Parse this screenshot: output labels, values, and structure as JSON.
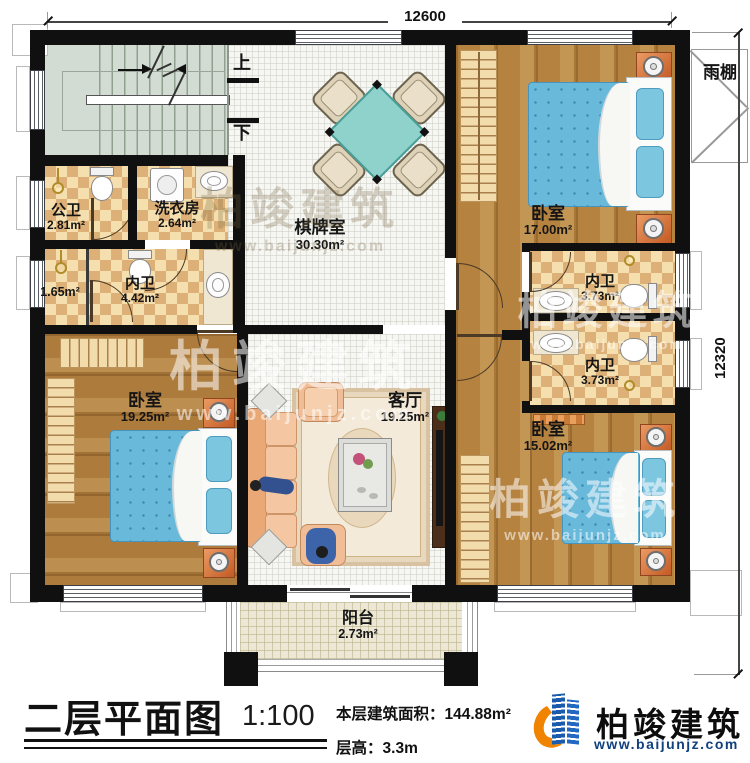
{
  "title": {
    "text": "二层平面图",
    "scale": "1:100",
    "area_label": "本层建筑面积：",
    "area_value": "144.88m²",
    "floor_height_label": "层高：",
    "floor_height_value": "3.3m"
  },
  "brand": {
    "name": "柏竣建筑",
    "url": "www.baijunjz.com"
  },
  "watermark": {
    "name": "柏竣建筑",
    "url": "www.baijunjz.com"
  },
  "dimensions": {
    "width_mm": "12600",
    "height_mm": "12320"
  },
  "stairs": {
    "up": "上",
    "down": "下"
  },
  "rooms": {
    "public_bath": {
      "name": "公卫",
      "area": "2.81m²"
    },
    "laundry": {
      "name": "洗衣房",
      "area": "2.64m²"
    },
    "chess": {
      "name": "棋牌室",
      "area": "30.30m²"
    },
    "bedroom_tr": {
      "name": "卧室",
      "area": "17.00m²"
    },
    "canopy": {
      "name": "雨棚"
    },
    "closet": {
      "area": "1.65m²"
    },
    "ensuite_main": {
      "name": "内卫",
      "area": "4.42m²"
    },
    "ensuite_upper": {
      "name": "内卫",
      "area": "3.73m²"
    },
    "ensuite_lower": {
      "name": "内卫",
      "area": "3.73m²"
    },
    "bedroom_bl": {
      "name": "卧室",
      "area": "19.25m²"
    },
    "living": {
      "name": "客厅",
      "area": "19.25m²"
    },
    "bedroom_br": {
      "name": "卧室",
      "area": "15.02m²"
    },
    "balcony": {
      "name": "阳台",
      "area": "2.73m²"
    }
  },
  "colors": {
    "wall": "#101010",
    "checker_light": "#f5dfae",
    "checker_dark": "#dcb076",
    "wood": "#b5823f",
    "bed_blue": "#69b9da",
    "table_teal": "#8fd2cc",
    "logo_blue": "#1b5bab",
    "logo_orange": "#f08300"
  }
}
